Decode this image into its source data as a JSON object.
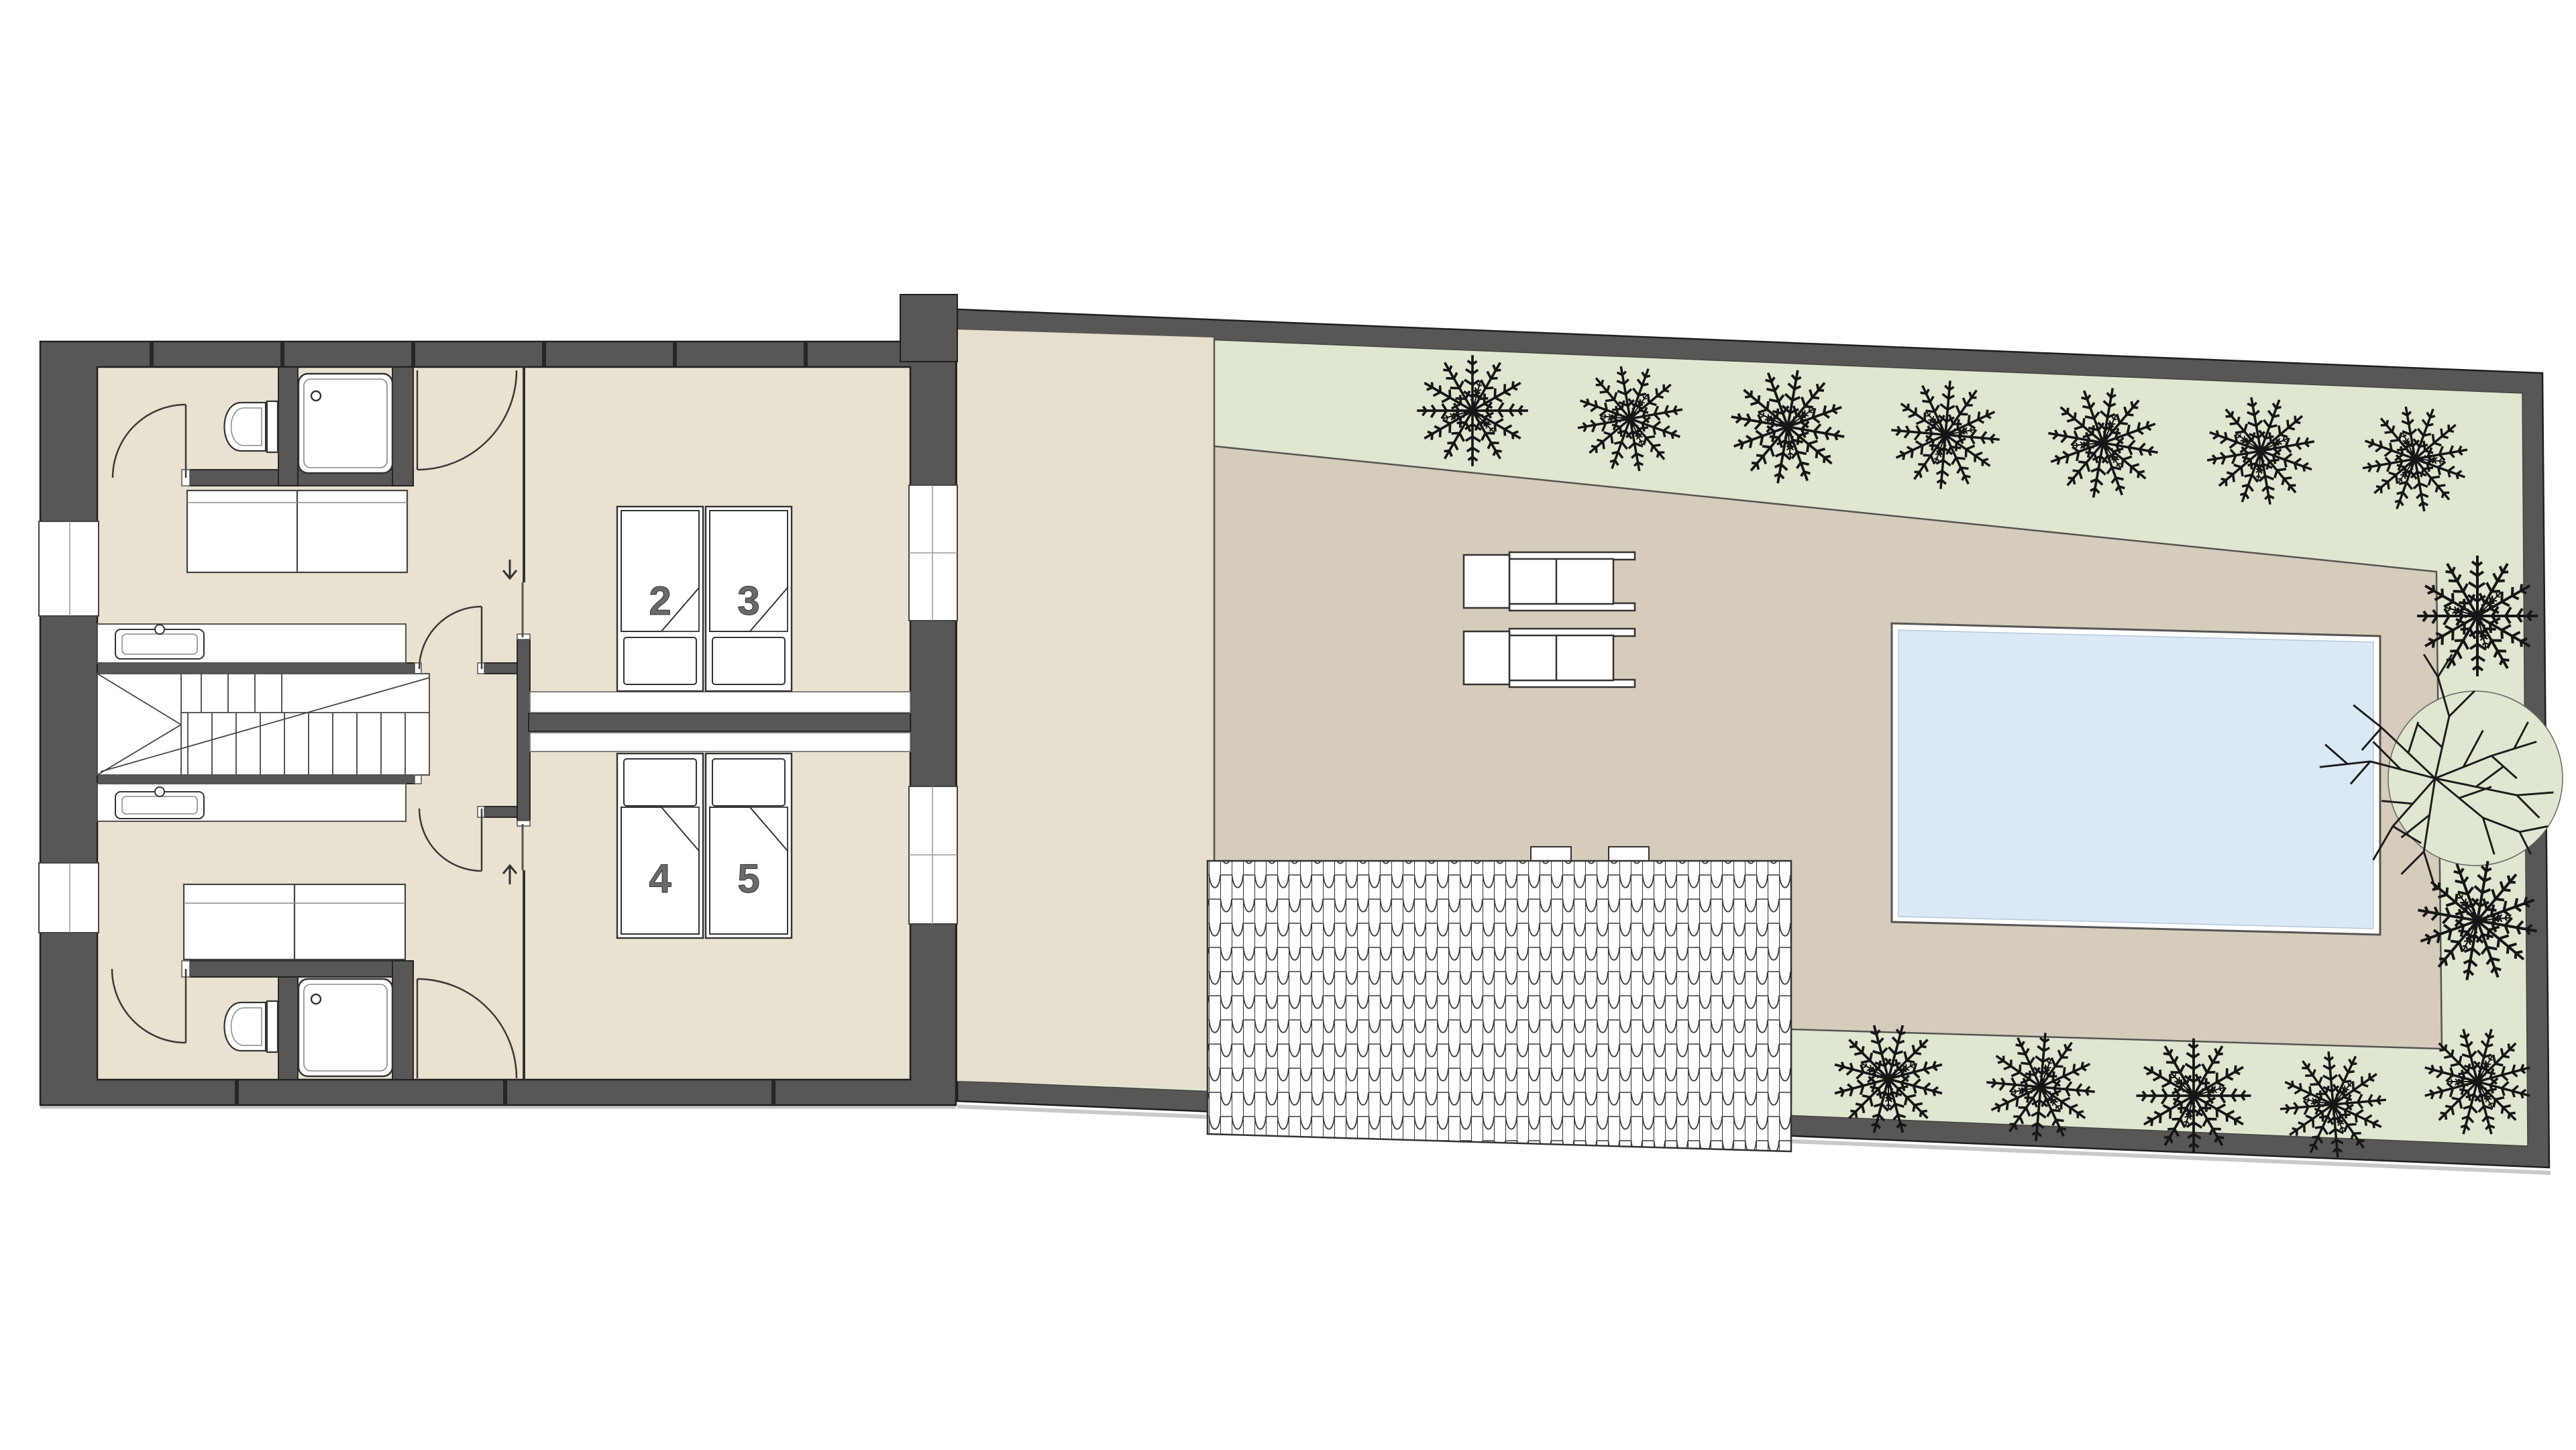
{
  "document": {
    "kind": "architectural-floor-plan",
    "view": "upper floor plan with roof terrace, pool and garden beds",
    "background": "#ffffff"
  },
  "labels": {
    "bed_2": "2",
    "bed_3": "3",
    "bed_4": "4",
    "bed_5": "5"
  },
  "colors": {
    "wall": "#585755",
    "floor": "#e9e2d1",
    "walkway": "#e6dfcd",
    "terrace": "#d5ccbb",
    "planting": "#e0e7d0",
    "water": "#dbe9f6",
    "ink": "#2b2b2b",
    "label": "#6a6a6a",
    "fixture": "#ffffff"
  },
  "features": {
    "single_beds": 4,
    "bed_labels": [
      "2",
      "3",
      "4",
      "5"
    ],
    "showers": 2,
    "toilets": 2,
    "washbasins": 2,
    "wardrobes": 2,
    "stair_flights": 2,
    "direction_arrows": [
      "down",
      "up"
    ],
    "sun_loungers": 2,
    "pools": 1,
    "shrubs": 14,
    "bare_trees": 1,
    "tiled_roof_area": 1,
    "windows": 4,
    "door_swings": 6
  }
}
